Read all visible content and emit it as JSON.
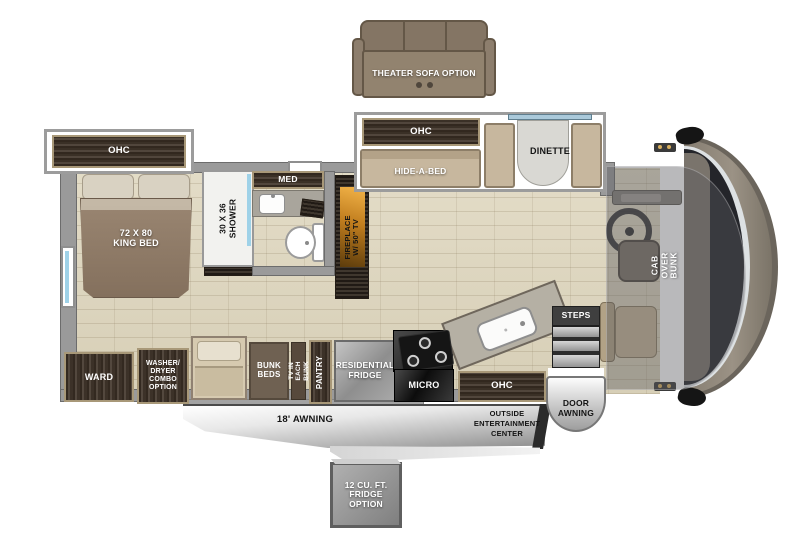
{
  "palette": {
    "floor_tile": "#ded6c0",
    "wall_gray": "#9a9a9a",
    "cabinet_wood": "#463a2f",
    "cabinet_trim": "#a89878",
    "sofa_tan": "#c7b79e",
    "fireplace_amber": "#e8a73e",
    "awning_silver": "#d9d9d9",
    "cab_body": "#8a8276",
    "windshield": "#24252a",
    "accent_window_blue": "#9fd2e8"
  },
  "slideouts": {
    "theater_sofa_option": "THEATER SOFA OPTION",
    "bedroom_ohc": "OHC",
    "living_ohc": "OHC",
    "hide_a_bed": "HIDE-A-BED",
    "dinette": "DINETTE"
  },
  "bedroom": {
    "king_bed_lines": [
      "72 X 80",
      "KING BED"
    ]
  },
  "bathroom": {
    "shower_lines": [
      "30 X 36",
      "SHOWER"
    ],
    "med": "MED"
  },
  "living": {
    "fireplace_lines": [
      "FIREPLACE",
      "W/ 50\" TV"
    ]
  },
  "cab": {
    "bunk_lines": [
      "CAB OVER",
      "BUNK"
    ]
  },
  "galley": {
    "ward": "WARD",
    "washer_dryer_lines": [
      "WASHER/",
      "DRYER",
      "COMBO",
      "OPTION"
    ],
    "bunk_beds_lines": [
      "BUNK",
      "BEDS"
    ],
    "tv_bunk_lines": [
      "TV IN",
      "EACH BUNK"
    ],
    "pantry": "PANTRY",
    "residential_fridge_lines": [
      "RESIDENTIAL",
      "FRIDGE"
    ],
    "micro": "MICRO",
    "kitchen_ohc": "OHC",
    "steps": "STEPS"
  },
  "exterior": {
    "door_awning_lines": [
      "DOOR",
      "AWNING"
    ],
    "awning": "18' AWNING",
    "entertainment_lines": [
      "OUTSIDE",
      "ENTERTAINMENT",
      "CENTER"
    ],
    "fridge_option_lines": [
      "12 CU. FT.",
      "FRIDGE",
      "OPTION"
    ]
  }
}
